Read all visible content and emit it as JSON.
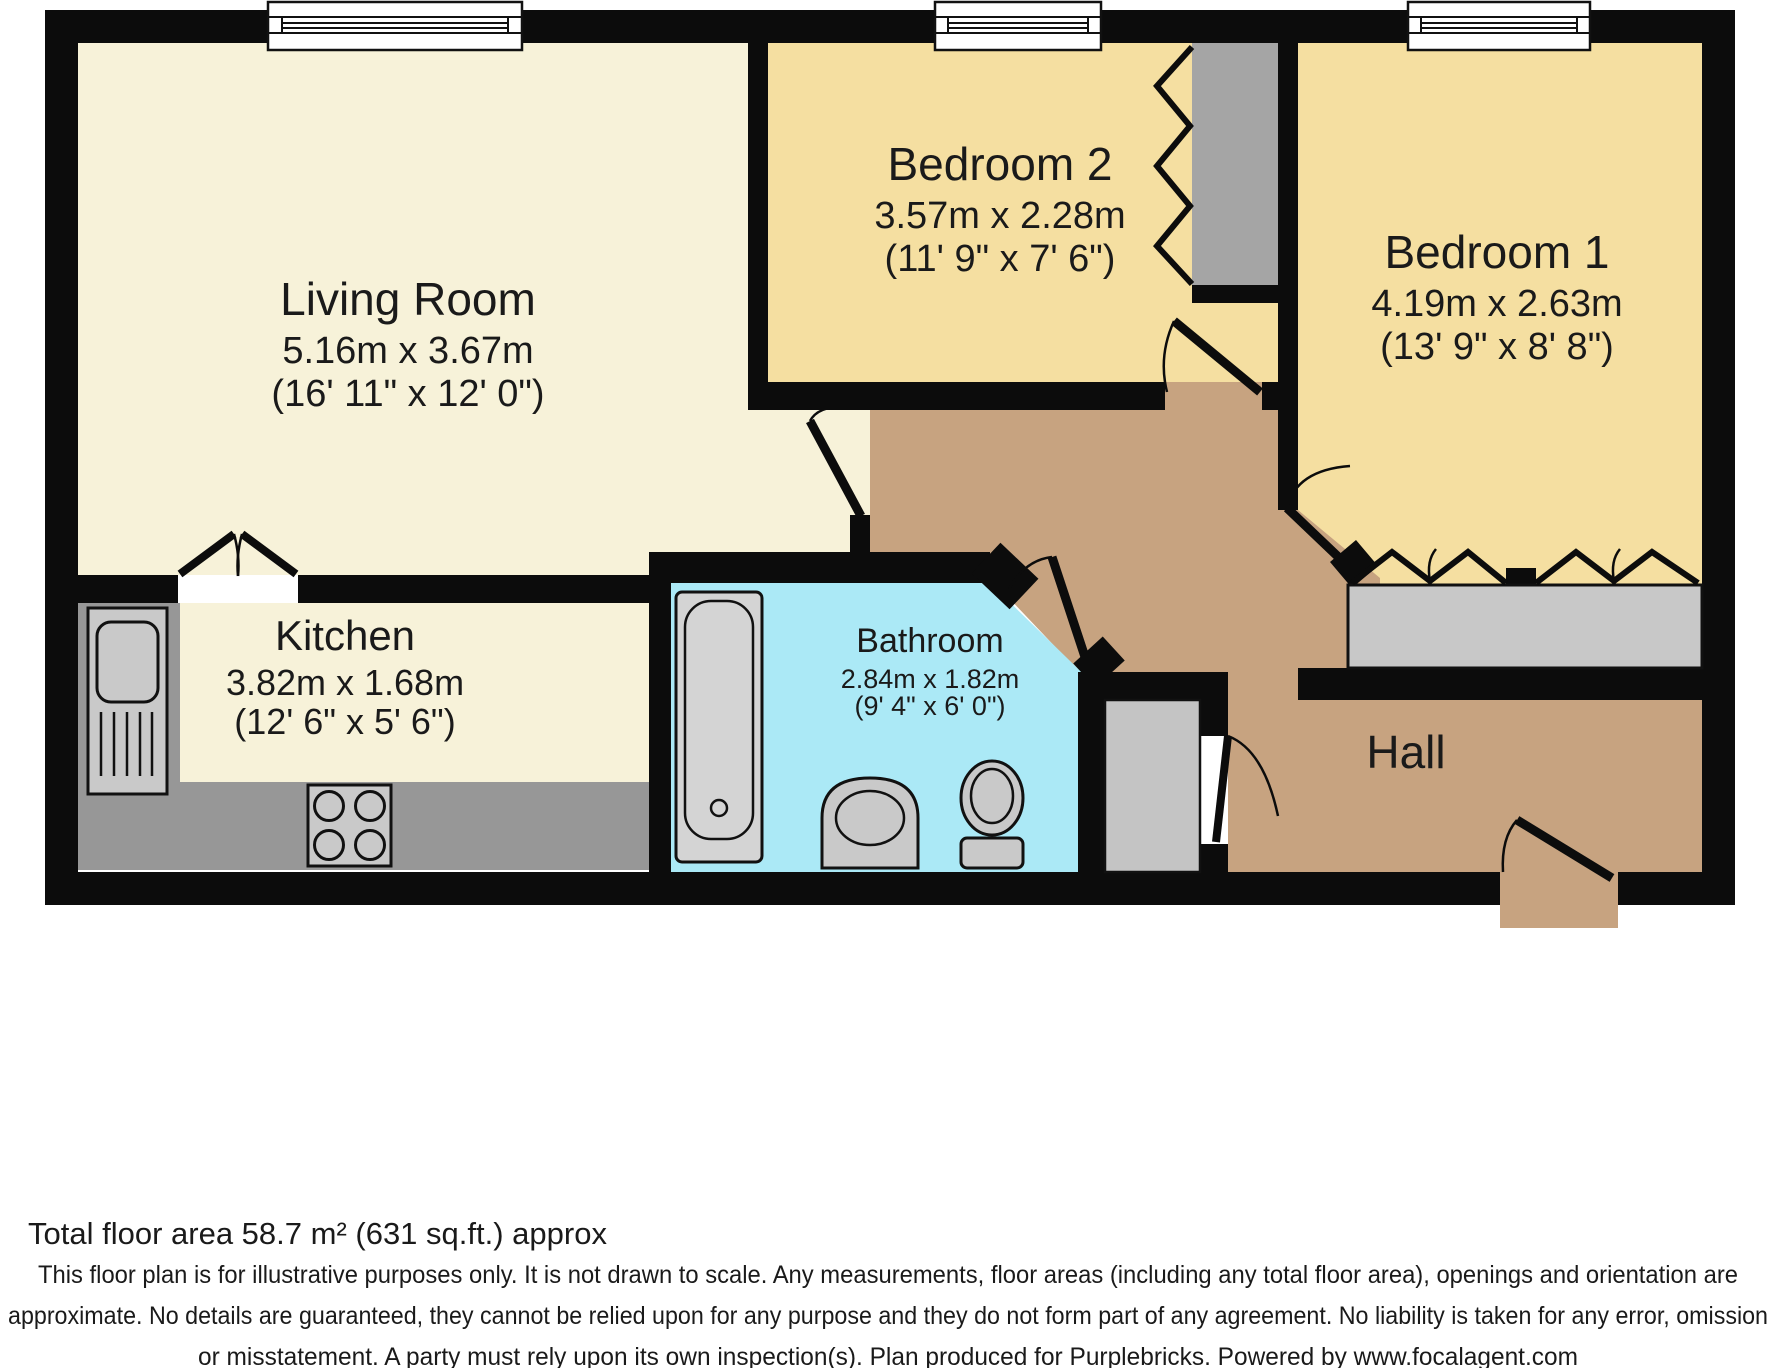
{
  "rooms": {
    "living_room": {
      "name": "Living Room",
      "metric": "5.16m x 3.67m",
      "imperial": "(16' 11\" x 12' 0\")"
    },
    "bedroom_2": {
      "name": "Bedroom 2",
      "metric": "3.57m x 2.28m",
      "imperial": "(11' 9\" x 7' 6\")"
    },
    "bedroom_1": {
      "name": "Bedroom 1",
      "metric": "4.19m x 2.63m",
      "imperial": "(13' 9\" x 8' 8\")"
    },
    "kitchen": {
      "name": "Kitchen",
      "metric": "3.82m x 1.68m",
      "imperial": "(12' 6\" x 5' 6\")"
    },
    "bathroom": {
      "name": "Bathroom",
      "metric": "2.84m x 1.82m",
      "imperial": "(9' 4\" x 6' 0\")"
    },
    "hall": {
      "name": "Hall"
    }
  },
  "footer": {
    "total_area": "Total floor area 58.7 m² (631 sq.ft.) approx",
    "disclaimer_line1": "This floor plan is for illustrative purposes only. It is not drawn to scale. Any measurements, floor areas (including any total floor area), openings and orientation are",
    "disclaimer_line2": "approximate. No details are guaranteed, they cannot be relied upon for any purpose and they do not form part of any agreement. No liability is taken for any error, omission",
    "disclaimer_line3": "or misstatement. A party must rely upon its own inspection(s). Plan produced for Purplebricks. Powered by www.focalagent.com"
  },
  "colors": {
    "wall": "#0c0c0c",
    "living_kitchen_floor": "#f7f2d9",
    "bedroom_floor": "#f5dfa1",
    "hall_floor": "#c7a380",
    "bathroom_floor": "#abe9f6",
    "counter_gray": "#979797",
    "fixture_gray": "#c9c9c9",
    "wardrobe_gray": "#a5a5a5",
    "window_white": "#ffffff"
  }
}
